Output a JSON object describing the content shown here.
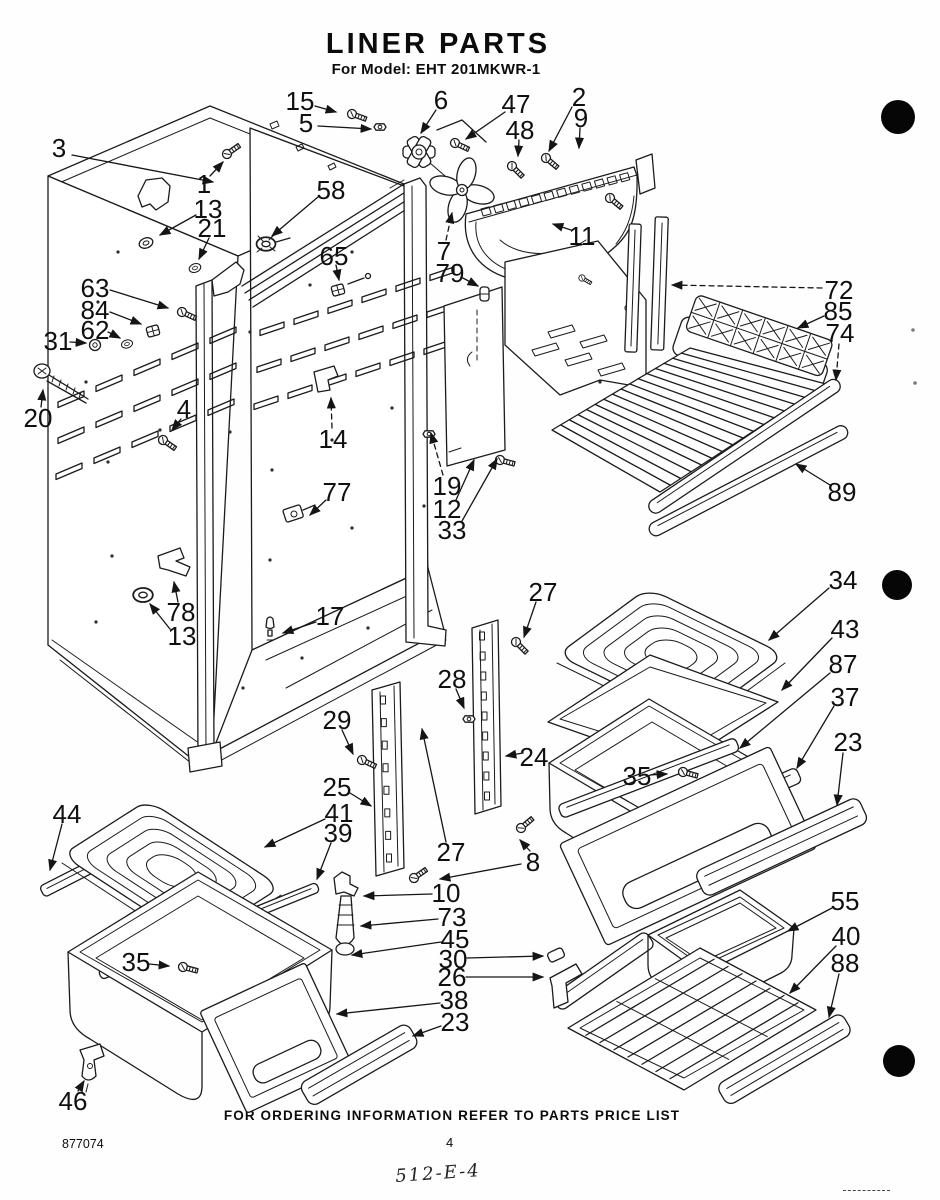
{
  "header": {
    "title": "LINER PARTS",
    "subtitle": "For Model: EHT 201MKWR-1"
  },
  "footer": {
    "note": "FOR ORDERING INFORMATION REFER TO PARTS PRICE LIST",
    "doc_number": "877074",
    "page_number": "4",
    "handwritten_code": "512-E-4"
  },
  "callouts": [
    {
      "n": "3",
      "x": 59,
      "y": 148,
      "l": [
        [
          72,
          155,
          213,
          182
        ]
      ]
    },
    {
      "n": "15",
      "x": 300,
      "y": 101,
      "l": [
        [
          315,
          106,
          336,
          112
        ]
      ]
    },
    {
      "n": "5",
      "x": 306,
      "y": 123,
      "l": [
        [
          318,
          126,
          371,
          129
        ]
      ]
    },
    {
      "n": "6",
      "x": 441,
      "y": 100,
      "l": [
        [
          436,
          110,
          421,
          133
        ]
      ]
    },
    {
      "n": "47",
      "x": 516,
      "y": 104,
      "l": [
        [
          505,
          112,
          466,
          139
        ]
      ]
    },
    {
      "n": "48",
      "x": 520,
      "y": 130,
      "l": [
        [
          519,
          140,
          518,
          156
        ]
      ]
    },
    {
      "n": "2",
      "x": 579,
      "y": 97,
      "l": [
        [
          572,
          107,
          549,
          151
        ]
      ]
    },
    {
      "n": "9",
      "x": 581,
      "y": 118,
      "l": [
        [
          580,
          128,
          579,
          148
        ]
      ]
    },
    {
      "n": "1",
      "x": 204,
      "y": 184,
      "l": [
        [
          210,
          176,
          223,
          162
        ]
      ]
    },
    {
      "n": "13",
      "x": 208,
      "y": 209,
      "l": [
        [
          196,
          215,
          160,
          235
        ]
      ]
    },
    {
      "n": "21",
      "x": 212,
      "y": 228,
      "l": [
        [
          209,
          238,
          199,
          259
        ]
      ]
    },
    {
      "n": "58",
      "x": 331,
      "y": 190,
      "l": [
        [
          318,
          197,
          272,
          236
        ]
      ]
    },
    {
      "n": "65",
      "x": 334,
      "y": 256,
      "l": [
        [
          336,
          265,
          339,
          280
        ]
      ]
    },
    {
      "n": "63",
      "x": 95,
      "y": 288,
      "l": [
        [
          110,
          290,
          168,
          308
        ]
      ]
    },
    {
      "n": "84",
      "x": 95,
      "y": 310,
      "l": [
        [
          110,
          312,
          141,
          324
        ]
      ]
    },
    {
      "n": "62",
      "x": 95,
      "y": 330,
      "l": [
        [
          108,
          332,
          120,
          338
        ]
      ]
    },
    {
      "n": "31",
      "x": 58,
      "y": 341,
      "l": [
        [
          70,
          342,
          86,
          343
        ]
      ]
    },
    {
      "n": "20",
      "x": 38,
      "y": 418,
      "l": [
        [
          41,
          407,
          43,
          390
        ]
      ]
    },
    {
      "n": "4",
      "x": 184,
      "y": 409,
      "l": [
        [
          181,
          419,
          172,
          430
        ]
      ]
    },
    {
      "n": "14",
      "x": 333,
      "y": 439,
      "d": 1,
      "l": [
        [
          332,
          428,
          331,
          398
        ]
      ]
    },
    {
      "n": "77",
      "x": 337,
      "y": 492,
      "l": [
        [
          326,
          500,
          310,
          515
        ]
      ]
    },
    {
      "n": "78",
      "x": 181,
      "y": 612,
      "l": [
        [
          178,
          602,
          174,
          582
        ]
      ]
    },
    {
      "n": "13",
      "x": 182,
      "y": 636,
      "l": [
        [
          170,
          629,
          150,
          604
        ]
      ]
    },
    {
      "n": "17",
      "x": 330,
      "y": 616,
      "l": [
        [
          316,
          622,
          283,
          633
        ]
      ]
    },
    {
      "n": "7",
      "x": 444,
      "y": 251,
      "d": 1,
      "l": [
        [
          446,
          240,
          452,
          213
        ]
      ]
    },
    {
      "n": "79",
      "x": 450,
      "y": 273,
      "l": [
        [
          461,
          277,
          478,
          286
        ]
      ]
    },
    {
      "n": "11",
      "x": 582,
      "y": 236,
      "l": [
        [
          571,
          230,
          553,
          224
        ]
      ]
    },
    {
      "n": "19",
      "x": 447,
      "y": 486,
      "d": 1,
      "l": [
        [
          443,
          475,
          431,
          433
        ]
      ]
    },
    {
      "n": "12",
      "x": 447,
      "y": 509,
      "l": [
        [
          456,
          500,
          474,
          460
        ]
      ]
    },
    {
      "n": "33",
      "x": 452,
      "y": 530,
      "l": [
        [
          462,
          521,
          497,
          459
        ]
      ]
    },
    {
      "n": "72",
      "x": 839,
      "y": 290,
      "d": 1,
      "l": [
        [
          822,
          288,
          672,
          285
        ]
      ]
    },
    {
      "n": "85",
      "x": 838,
      "y": 311,
      "l": [
        [
          824,
          316,
          798,
          328
        ]
      ]
    },
    {
      "n": "74",
      "x": 840,
      "y": 333,
      "d": 1,
      "l": [
        [
          839,
          344,
          836,
          380
        ]
      ]
    },
    {
      "n": "89",
      "x": 842,
      "y": 492,
      "l": [
        [
          830,
          485,
          796,
          464
        ]
      ]
    },
    {
      "n": "34",
      "x": 843,
      "y": 580,
      "l": [
        [
          829,
          588,
          769,
          640
        ]
      ]
    },
    {
      "n": "43",
      "x": 845,
      "y": 629,
      "l": [
        [
          832,
          638,
          782,
          690
        ]
      ]
    },
    {
      "n": "87",
      "x": 843,
      "y": 664,
      "l": [
        [
          830,
          673,
          740,
          748
        ]
      ]
    },
    {
      "n": "37",
      "x": 845,
      "y": 697,
      "l": [
        [
          834,
          706,
          797,
          768
        ]
      ]
    },
    {
      "n": "23",
      "x": 848,
      "y": 742,
      "l": [
        [
          843,
          753,
          837,
          805
        ]
      ]
    },
    {
      "n": "27",
      "x": 543,
      "y": 592,
      "l": [
        [
          536,
          602,
          524,
          637
        ]
      ]
    },
    {
      "n": "28",
      "x": 452,
      "y": 679,
      "l": [
        [
          456,
          689,
          464,
          708
        ]
      ]
    },
    {
      "n": "24",
      "x": 534,
      "y": 757,
      "l": [
        [
          523,
          753,
          506,
          756
        ]
      ]
    },
    {
      "n": "35",
      "x": 637,
      "y": 776,
      "l": [
        [
          650,
          775,
          667,
          774
        ]
      ]
    },
    {
      "n": "29",
      "x": 337,
      "y": 720,
      "l": [
        [
          342,
          730,
          353,
          754
        ]
      ]
    },
    {
      "n": "25",
      "x": 337,
      "y": 787,
      "l": [
        [
          350,
          793,
          371,
          806
        ]
      ]
    },
    {
      "n": "41",
      "x": 339,
      "y": 813,
      "l": [
        [
          325,
          819,
          265,
          847
        ]
      ]
    },
    {
      "n": "39",
      "x": 338,
      "y": 833,
      "l": [
        [
          331,
          843,
          317,
          879
        ]
      ]
    },
    {
      "n": "8",
      "x": 533,
      "y": 862,
      "l": [
        [
          530,
          851,
          520,
          840
        ],
        [
          521,
          864,
          440,
          879
        ]
      ]
    },
    {
      "n": "27",
      "x": 451,
      "y": 852,
      "l": [
        [
          446,
          842,
          422,
          729
        ]
      ]
    },
    {
      "n": "10",
      "x": 446,
      "y": 893,
      "l": [
        [
          432,
          894,
          364,
          896
        ]
      ]
    },
    {
      "n": "73",
      "x": 452,
      "y": 917,
      "l": [
        [
          438,
          919,
          361,
          926
        ]
      ]
    },
    {
      "n": "45",
      "x": 455,
      "y": 939,
      "l": [
        [
          441,
          942,
          352,
          955
        ]
      ]
    },
    {
      "n": "30",
      "x": 453,
      "y": 959,
      "l": [
        [
          467,
          958,
          543,
          956
        ]
      ]
    },
    {
      "n": "26",
      "x": 452,
      "y": 977,
      "l": [
        [
          466,
          977,
          543,
          977
        ]
      ]
    },
    {
      "n": "38",
      "x": 454,
      "y": 1000,
      "l": [
        [
          440,
          1003,
          337,
          1014
        ]
      ]
    },
    {
      "n": "23",
      "x": 455,
      "y": 1022,
      "l": [
        [
          441,
          1026,
          413,
          1036
        ]
      ]
    },
    {
      "n": "44",
      "x": 67,
      "y": 814,
      "l": [
        [
          62,
          824,
          50,
          870
        ]
      ]
    },
    {
      "n": "35",
      "x": 136,
      "y": 962,
      "l": [
        [
          149,
          964,
          169,
          966
        ]
      ]
    },
    {
      "n": "46",
      "x": 73,
      "y": 1101,
      "l": [
        [
          78,
          1091,
          84,
          1081
        ]
      ]
    },
    {
      "n": "55",
      "x": 845,
      "y": 901,
      "l": [
        [
          832,
          908,
          788,
          931
        ]
      ]
    },
    {
      "n": "40",
      "x": 846,
      "y": 936,
      "l": [
        [
          836,
          946,
          790,
          993
        ]
      ]
    },
    {
      "n": "88",
      "x": 845,
      "y": 963,
      "l": [
        [
          839,
          974,
          829,
          1017
        ]
      ]
    }
  ]
}
